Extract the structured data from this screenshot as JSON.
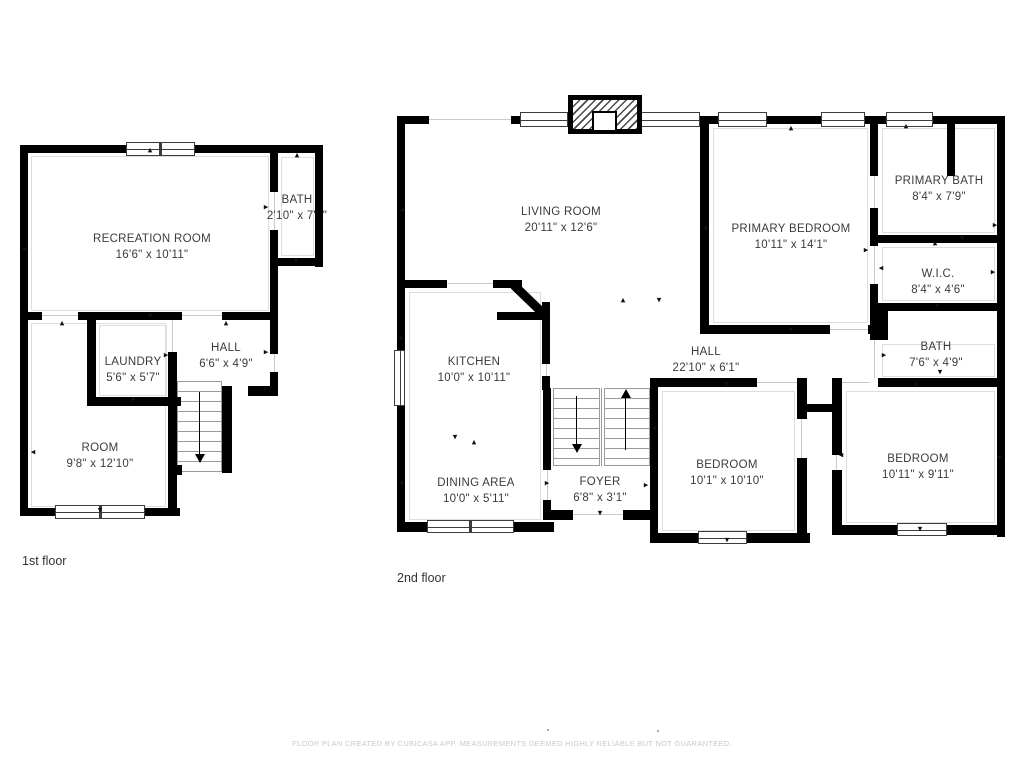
{
  "page": {
    "background": "#ffffff"
  },
  "footer": {
    "disclaimer": "FLOOR PLAN CREATED BY CUBICASA APP. MEASUREMENTS DEEMED HIGHLY RELIABLE BUT NOT GUARANTEED."
  },
  "colors": {
    "wall": "#000000",
    "room_label": "#3b3b3b",
    "floor_label": "#333333",
    "footer_text": "#c9c9c9"
  },
  "floors": {
    "first": {
      "label": "1st floor",
      "rooms": {
        "recreation": {
          "name": "RECREATION ROOM",
          "dims": "16'6\" x 10'11\""
        },
        "bath": {
          "name": "BATH",
          "dims": "2'10\" x 7'4\""
        },
        "laundry": {
          "name": "LAUNDRY",
          "dims": "5'6\" x 5'7\""
        },
        "hall": {
          "name": "HALL",
          "dims": "6'6\" x 4'9\""
        },
        "room": {
          "name": "ROOM",
          "dims": "9'8\" x 12'10\""
        }
      }
    },
    "second": {
      "label": "2nd floor",
      "rooms": {
        "living": {
          "name": "LIVING ROOM",
          "dims": "20'11\" x 12'6\""
        },
        "kitchen": {
          "name": "KITCHEN",
          "dims": "10'0\" x 10'11\""
        },
        "dining": {
          "name": "DINING AREA",
          "dims": "10'0\" x 5'11\""
        },
        "foyer": {
          "name": "FOYER",
          "dims": "6'8\" x 3'1\""
        },
        "hall": {
          "name": "HALL",
          "dims": "22'10\" x 6'1\""
        },
        "primary_bedroom": {
          "name": "PRIMARY BEDROOM",
          "dims": "10'11\" x 14'1\""
        },
        "primary_bath": {
          "name": "PRIMARY BATH",
          "dims": "8'4\" x 7'9\""
        },
        "wic": {
          "name": "W.I.C.",
          "dims": "8'4\" x 4'6\""
        },
        "bath": {
          "name": "BATH",
          "dims": "7'6\" x 4'9\""
        },
        "bedroom_left": {
          "name": "BEDROOM",
          "dims": "10'1\" x 10'10\""
        },
        "bedroom_right": {
          "name": "BEDROOM",
          "dims": "10'11\" x 9'11\""
        }
      }
    }
  }
}
